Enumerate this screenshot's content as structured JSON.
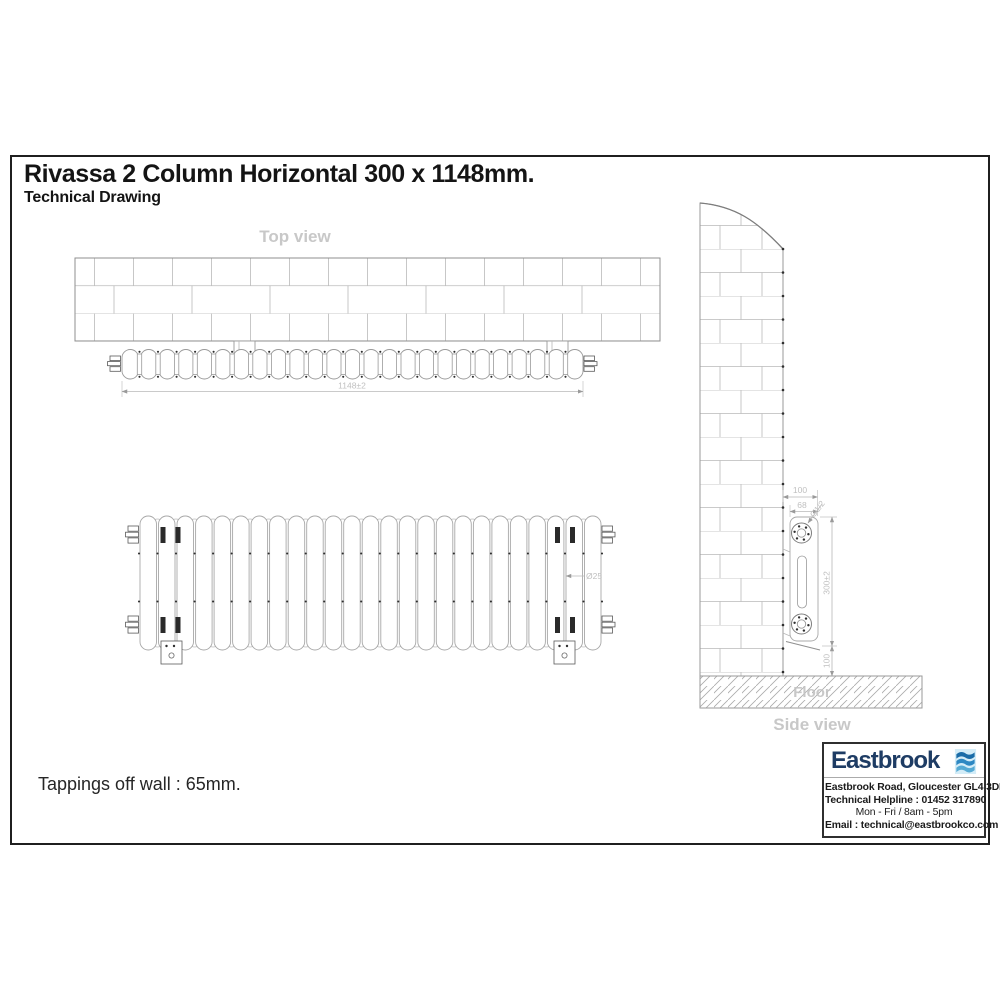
{
  "page": {
    "title": "Rivassa 2 Column Horizontal 300 x 1148mm.",
    "subtitle": "Technical Drawing",
    "note": "Tappings off wall : 65mm."
  },
  "drawing": {
    "sections": 25,
    "top_view": {
      "label": "Top view",
      "width_dim": "1148±2"
    },
    "front_view": {
      "column_dia_dim": "Ø25"
    },
    "side_view": {
      "label": "Side view",
      "floor_label": "Floor",
      "wall_offset_dim": "100",
      "depth_dim": "68",
      "tapping_thread_dim": "G1/2",
      "height_dim": "300±2",
      "floor_clearance_dim": "100"
    }
  },
  "footer_card": {
    "brand": "Eastbrook",
    "address": "Eastbrook Road, Gloucester GL4 3DB",
    "helpline": "Technical Helpline : 01452 317890",
    "hours": "Mon - Fri / 8am - 5pm",
    "email": "Email : technical@eastbrookco.com"
  },
  "colors": {
    "brand_navy": "#1e3c64",
    "logo_bg": "#d3ecf7",
    "wave_top": "#1a6ca8",
    "wave_mid": "#2d88c3",
    "wave_bottom": "#55aad4",
    "drawing_line": "#9a9a9a",
    "dim_text": "#c0c0c0"
  }
}
